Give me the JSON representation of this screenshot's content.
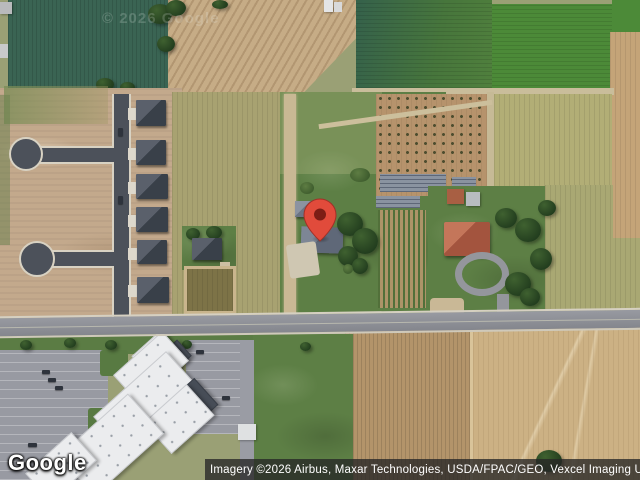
{
  "map": {
    "type": "satellite-imagery",
    "watermark": "© 2026 Google",
    "marker": {
      "name": "location-pin",
      "color": "#E14B3B",
      "outline_color": "#A03027",
      "dot_color": "#7C1D15"
    }
  },
  "footer": {
    "logo_text": "Google",
    "attribution_text": "Imagery ©2026 Airbus, Maxar Technologies, USDA/FPAC/GEO, Vexcel Imaging US, Inc."
  },
  "palette": {
    "attribution_bg": "#262626",
    "road_asphalt": "#4C515A",
    "main_road": "#90929A",
    "field_dark_green": "#3A6453",
    "field_bright_green": "#4C8A38",
    "field_tan": "#C6AC86",
    "wheat_light": "#CCB184",
    "lawn_green": "#5D7F45"
  }
}
